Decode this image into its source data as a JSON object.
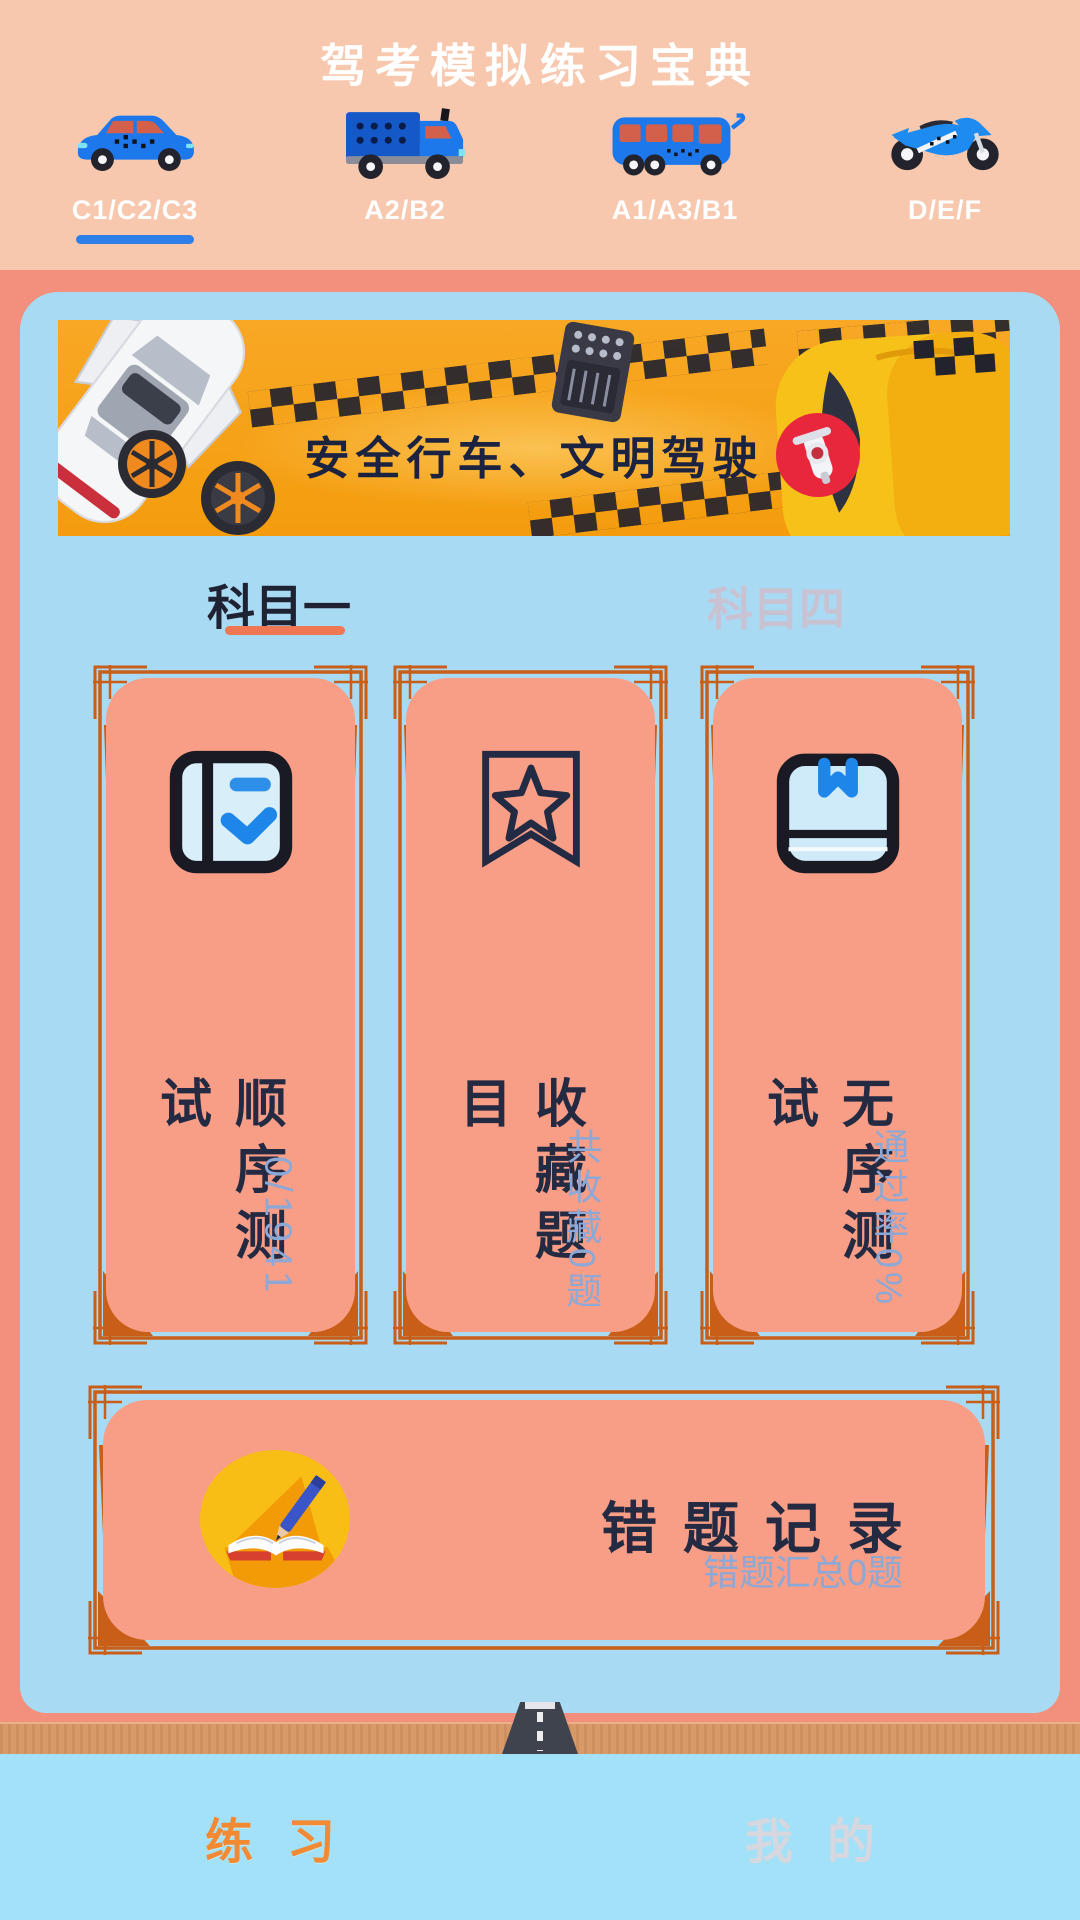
{
  "header": {
    "title": "驾考模拟练习宝典",
    "categories": [
      {
        "label": "C1/C2/C3",
        "icon": "car-icon",
        "active": true
      },
      {
        "label": "A2/B2",
        "icon": "truck-icon",
        "active": false
      },
      {
        "label": "A1/A3/B1",
        "icon": "bus-icon",
        "active": false
      },
      {
        "label": "D/E/F",
        "icon": "motorcycle-icon",
        "active": false
      }
    ]
  },
  "banner": {
    "slogan": "安全行车、文明驾驶"
  },
  "subjects": [
    {
      "label": "科目一",
      "active": true
    },
    {
      "label": "科目四",
      "active": false
    }
  ],
  "cards": [
    {
      "title": "顺序测试",
      "subtitle": "0/1941",
      "icon": "notebook-check-icon"
    },
    {
      "title": "收藏题目",
      "subtitle": "共收藏0题",
      "icon": "bookmark-star-icon"
    },
    {
      "title": "无序测试",
      "subtitle": "通过率0%",
      "icon": "book-ribbon-icon"
    }
  ],
  "wrong_card": {
    "title": "错题记录",
    "subtitle": "错题汇总0题",
    "icon": "book-pen-icon"
  },
  "nav": [
    {
      "label": "练习",
      "active": true
    },
    {
      "label": "我的",
      "active": false
    }
  ],
  "colors": {
    "header_bg": "#F7C8AE",
    "body_bg": "#F2907D",
    "panel_bg": "#A9DAF3",
    "card_bg": "#F89E86",
    "frame": "#C85E17",
    "banner_bg": "#F6A41F",
    "ink": "#232A42",
    "subtle_blue": "#8CA8D6",
    "tab_underline": "#EF7753",
    "category_underline": "#2E7FE8",
    "vehicle_blue": "#1D78EC",
    "nav_bg": "#A2E1F7",
    "nav_active": "#F18A33",
    "nav_inactive": "#D6D7DF",
    "accent_yellow": "#F8BE15"
  }
}
